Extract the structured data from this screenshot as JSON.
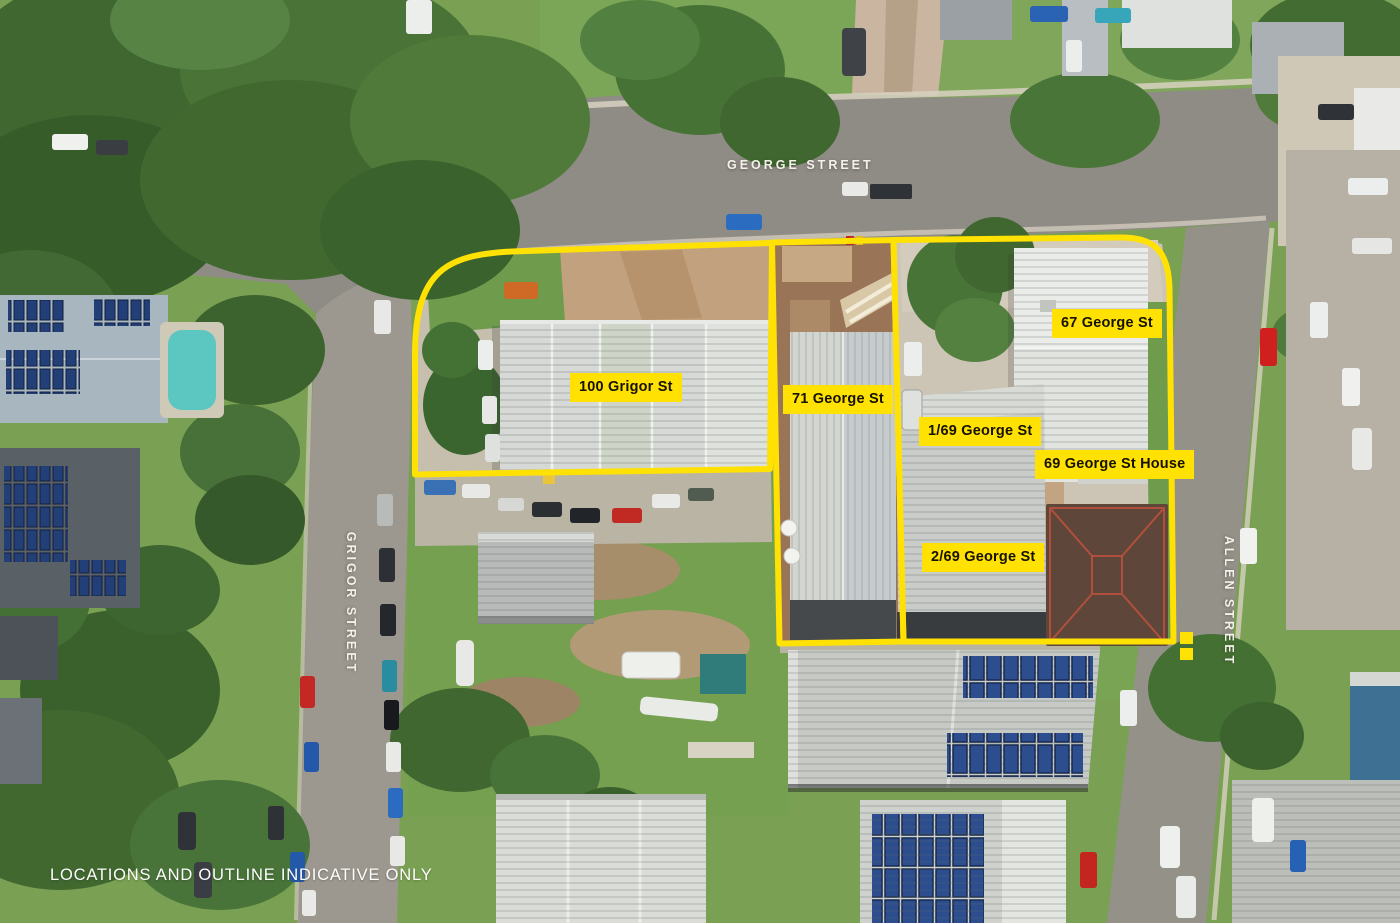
{
  "image_type": "aerial-property-marketing-photo",
  "streets": {
    "george": {
      "label": "GEORGE STREET"
    },
    "grigor": {
      "label": "GRIGOR STREET"
    },
    "allen": {
      "label": "ALLEN STREET"
    }
  },
  "parcel_labels": {
    "grigor100": {
      "text": "100 Grigor St"
    },
    "george71": {
      "text": "71 George St"
    },
    "george67": {
      "text": "67 George St"
    },
    "george69_1": {
      "text": "1/69 George St"
    },
    "george69_house": {
      "text": "69 George St House"
    },
    "george69_2": {
      "text": "2/69 George St"
    }
  },
  "disclaimer": {
    "text": "LOCATIONS AND OUTLINE INDICATIVE ONLY"
  },
  "colors": {
    "outline_yellow": "#FFE103",
    "label_bg": "#FFE103",
    "label_text": "#151200",
    "street_text": "#F4F1EA",
    "road_grey": "#8F8C85",
    "grass_green": "#7AA153",
    "tree_green": "#3F672F"
  }
}
